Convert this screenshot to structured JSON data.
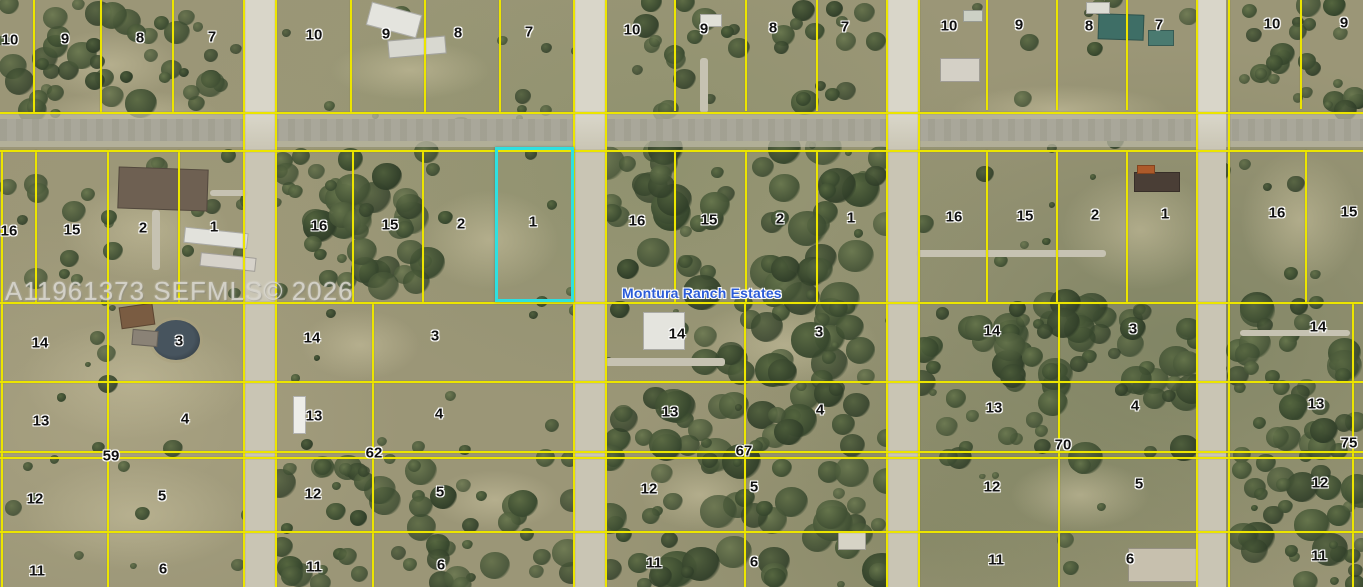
{
  "watermark": {
    "text": "A11961373 SEFMLS© 2026",
    "x": 5,
    "y": 276
  },
  "map_label": {
    "text": "Montura Ranch Estates",
    "x": 622,
    "y": 293
  },
  "highlight": {
    "lot": "1",
    "x": 495,
    "y": 147,
    "w": 79,
    "h": 155,
    "color": "#2ee0e0"
  },
  "colors": {
    "parcel_line": "#ece500",
    "highlight": "#2ee0e0",
    "lot_label_text": "#101010",
    "lot_label_halo": "#ffffff",
    "map_label_text": "#2b5cd8",
    "watermark_text": "#d8d6ce",
    "road": "#c9c5b4",
    "terrain_base": "#9b9677",
    "pond": "#3c4750"
  },
  "parcel_labels": [
    {
      "t": "10",
      "x": 10,
      "y": 40
    },
    {
      "t": "9",
      "x": 65,
      "y": 39
    },
    {
      "t": "8",
      "x": 140,
      "y": 38
    },
    {
      "t": "7",
      "x": 212,
      "y": 37
    },
    {
      "t": "10",
      "x": 314,
      "y": 35
    },
    {
      "t": "9",
      "x": 386,
      "y": 34
    },
    {
      "t": "8",
      "x": 458,
      "y": 33
    },
    {
      "t": "7",
      "x": 529,
      "y": 32
    },
    {
      "t": "10",
      "x": 632,
      "y": 30
    },
    {
      "t": "9",
      "x": 704,
      "y": 29
    },
    {
      "t": "8",
      "x": 773,
      "y": 28
    },
    {
      "t": "7",
      "x": 845,
      "y": 27
    },
    {
      "t": "10",
      "x": 949,
      "y": 26
    },
    {
      "t": "9",
      "x": 1019,
      "y": 25
    },
    {
      "t": "8",
      "x": 1089,
      "y": 26
    },
    {
      "t": "7",
      "x": 1159,
      "y": 25
    },
    {
      "t": "10",
      "x": 1272,
      "y": 24
    },
    {
      "t": "9",
      "x": 1344,
      "y": 23
    },
    {
      "t": "16",
      "x": 9,
      "y": 231
    },
    {
      "t": "15",
      "x": 72,
      "y": 230
    },
    {
      "t": "2",
      "x": 143,
      "y": 228
    },
    {
      "t": "1",
      "x": 214,
      "y": 227
    },
    {
      "t": "16",
      "x": 319,
      "y": 226
    },
    {
      "t": "15",
      "x": 390,
      "y": 225
    },
    {
      "t": "2",
      "x": 461,
      "y": 224
    },
    {
      "t": "1",
      "x": 533,
      "y": 222
    },
    {
      "t": "16",
      "x": 637,
      "y": 221
    },
    {
      "t": "15",
      "x": 709,
      "y": 220
    },
    {
      "t": "2",
      "x": 780,
      "y": 219
    },
    {
      "t": "1",
      "x": 851,
      "y": 218
    },
    {
      "t": "16",
      "x": 954,
      "y": 217
    },
    {
      "t": "15",
      "x": 1025,
      "y": 216
    },
    {
      "t": "2",
      "x": 1095,
      "y": 215
    },
    {
      "t": "1",
      "x": 1165,
      "y": 214
    },
    {
      "t": "16",
      "x": 1277,
      "y": 213
    },
    {
      "t": "15",
      "x": 1349,
      "y": 212
    },
    {
      "t": "14",
      "x": 40,
      "y": 343
    },
    {
      "t": "3",
      "x": 179,
      "y": 341
    },
    {
      "t": "14",
      "x": 312,
      "y": 338
    },
    {
      "t": "3",
      "x": 435,
      "y": 336
    },
    {
      "t": "14",
      "x": 677,
      "y": 334
    },
    {
      "t": "3",
      "x": 819,
      "y": 332
    },
    {
      "t": "14",
      "x": 992,
      "y": 331
    },
    {
      "t": "3",
      "x": 1133,
      "y": 329
    },
    {
      "t": "14",
      "x": 1318,
      "y": 327
    },
    {
      "t": "13",
      "x": 41,
      "y": 421
    },
    {
      "t": "4",
      "x": 185,
      "y": 419
    },
    {
      "t": "13",
      "x": 314,
      "y": 416
    },
    {
      "t": "4",
      "x": 439,
      "y": 414
    },
    {
      "t": "13",
      "x": 670,
      "y": 412
    },
    {
      "t": "4",
      "x": 820,
      "y": 410
    },
    {
      "t": "13",
      "x": 994,
      "y": 408
    },
    {
      "t": "4",
      "x": 1135,
      "y": 406
    },
    {
      "t": "13",
      "x": 1316,
      "y": 404
    },
    {
      "t": "12",
      "x": 35,
      "y": 499
    },
    {
      "t": "5",
      "x": 162,
      "y": 496
    },
    {
      "t": "12",
      "x": 313,
      "y": 494
    },
    {
      "t": "5",
      "x": 440,
      "y": 492
    },
    {
      "t": "12",
      "x": 649,
      "y": 489
    },
    {
      "t": "5",
      "x": 754,
      "y": 487
    },
    {
      "t": "12",
      "x": 992,
      "y": 487
    },
    {
      "t": "5",
      "x": 1139,
      "y": 484
    },
    {
      "t": "12",
      "x": 1320,
      "y": 483
    },
    {
      "t": "11",
      "x": 37,
      "y": 571
    },
    {
      "t": "6",
      "x": 163,
      "y": 569
    },
    {
      "t": "11",
      "x": 314,
      "y": 567
    },
    {
      "t": "6",
      "x": 441,
      "y": 565
    },
    {
      "t": "11",
      "x": 654,
      "y": 563
    },
    {
      "t": "6",
      "x": 754,
      "y": 562
    },
    {
      "t": "11",
      "x": 996,
      "y": 560
    },
    {
      "t": "6",
      "x": 1130,
      "y": 559
    },
    {
      "t": "11",
      "x": 1319,
      "y": 556
    }
  ],
  "street_numbers": [
    {
      "t": "59",
      "x": 111,
      "y": 456
    },
    {
      "t": "62",
      "x": 374,
      "y": 453
    },
    {
      "t": "67",
      "x": 744,
      "y": 451
    },
    {
      "t": "70",
      "x": 1063,
      "y": 445
    },
    {
      "t": "75",
      "x": 1349,
      "y": 443
    }
  ]
}
